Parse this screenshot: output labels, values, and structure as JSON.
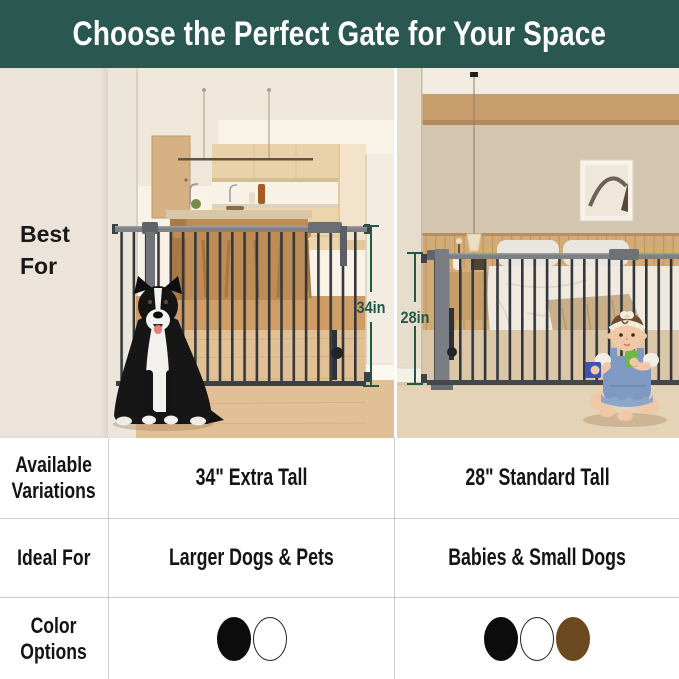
{
  "header": {
    "title": "Choose the Perfect Gate for Your Space"
  },
  "comparison": {
    "row_labels": {
      "best_for": "Best\nFor",
      "variations": "Available\nVariations",
      "ideal_for": "Ideal For",
      "colors": "Color\nOptions"
    },
    "left": {
      "measurement": "34in",
      "variation": "34\" Extra Tall",
      "ideal": "Larger Dogs & Pets",
      "swatches": [
        {
          "name": "black",
          "hex": "#0c0c0c",
          "outline": false
        },
        {
          "name": "white",
          "hex": "#ffffff",
          "outline": true
        }
      ]
    },
    "right": {
      "measurement": "28in",
      "variation": "28\" Standard Tall",
      "ideal": "Babies & Small Dogs",
      "swatches": [
        {
          "name": "black",
          "hex": "#0c0c0c",
          "outline": false
        },
        {
          "name": "white",
          "hex": "#ffffff",
          "outline": true
        },
        {
          "name": "brown",
          "hex": "#6b4a21",
          "outline": false
        }
      ]
    }
  },
  "colors": {
    "header_bg": "#2a574f",
    "header_text": "#ffffff",
    "sidebar_bg": "#ece3da",
    "measure_green": "#1e5a4a",
    "grid_line": "#cccccc"
  }
}
